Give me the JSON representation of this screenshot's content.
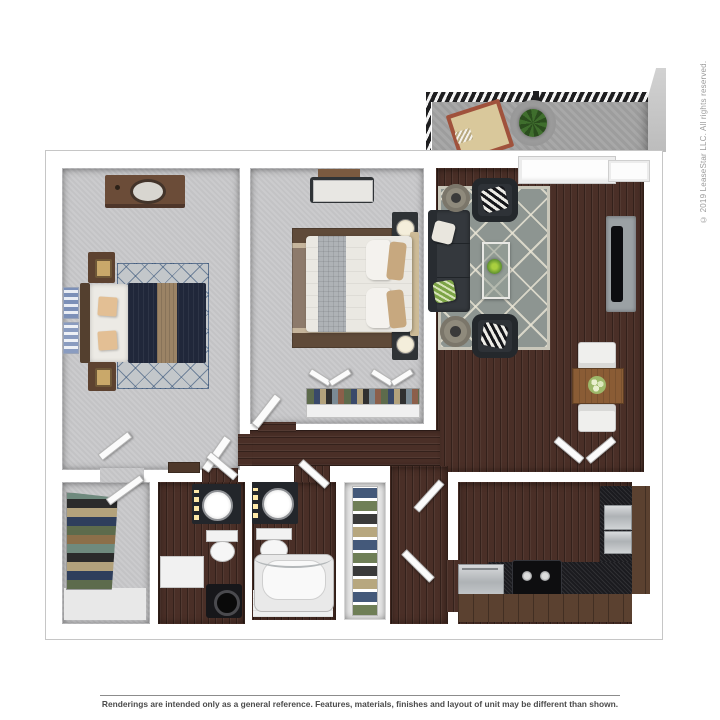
{
  "page": {
    "background": "#ffffff",
    "copyright": "© 2019 LeaseStar LLC. All rights reserved.",
    "disclaimer": "Renderings are intended only as a general reference. Features, materials, finishes and layout of unit may be different than shown."
  },
  "floorplan": {
    "description": "3D top-down rendering of a two-bedroom, two-bathroom apartment with balcony, living room, dining nook and galley kitchen",
    "rooms": [
      "balcony",
      "living-room",
      "dining-area",
      "kitchen",
      "bedroom-1",
      "bedroom-2",
      "bathroom-1",
      "bathroom-2",
      "walk-in-closet",
      "linen-closet",
      "hallway",
      "entry"
    ],
    "colors": {
      "carpet": "#c8c8ca",
      "hardwood": "#4a2f27",
      "balcony_concrete": "#a3a3a3",
      "railing": "#1d1d1f",
      "wall_line": "#c6c6c6",
      "bed1_comforter": "#20273a",
      "bed1_stripe": "#9b8365",
      "accent_tan": "#e3bf94",
      "bed2_duvet": "#eae8e2",
      "bed2_runner": "#aeb2b6",
      "sofa": "#34383d",
      "living_rug": "#8d9591",
      "counter_granite": "#1b1b1f",
      "cabinet_wood": "#5b4130",
      "plant_green": "#3f6e2d",
      "lounge_cushion": "#d9c89b",
      "lounge_frame": "#a0523c"
    }
  }
}
